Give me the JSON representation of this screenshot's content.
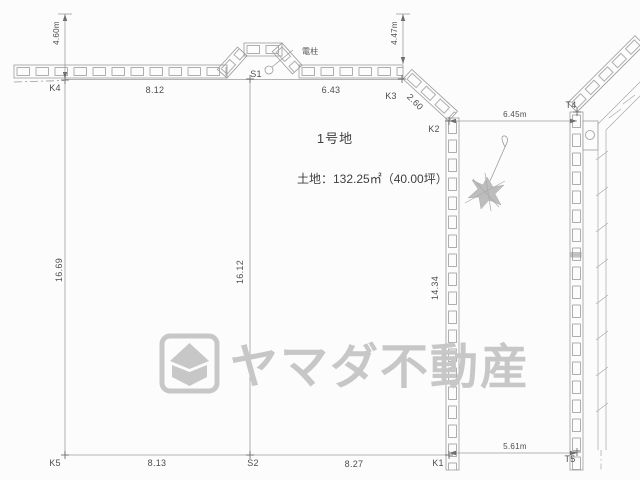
{
  "drawing": {
    "lot": {
      "name": "1号地",
      "area": "土地：132.25㎡（40.00坪）"
    },
    "points": {
      "k4": "K4",
      "k3": "K3",
      "k2": "K2",
      "k1": "K1",
      "k5": "K5",
      "s1": "S1",
      "s2": "S2",
      "t4": "T4",
      "t5": "T5"
    },
    "dims": {
      "top_left": "8.12",
      "top_right": "6.43",
      "ne_diagonal": "2.60",
      "west": "16.69",
      "center": "16.12",
      "east": "14.34",
      "bottom_left": "8.13",
      "bottom_right": "8.27",
      "road_east_top": "6.45m",
      "road_east_bottom": "5.61m",
      "road_width_left": "4.60m",
      "road_width_right": "4.47m"
    },
    "labels": {
      "utility_pole": "電柱"
    },
    "watermark": {
      "company": "ヤマダ不動産"
    },
    "colors": {
      "line": "#9b9b9b",
      "text": "#4e4e4e",
      "watermark": "#c7c7c7"
    }
  }
}
